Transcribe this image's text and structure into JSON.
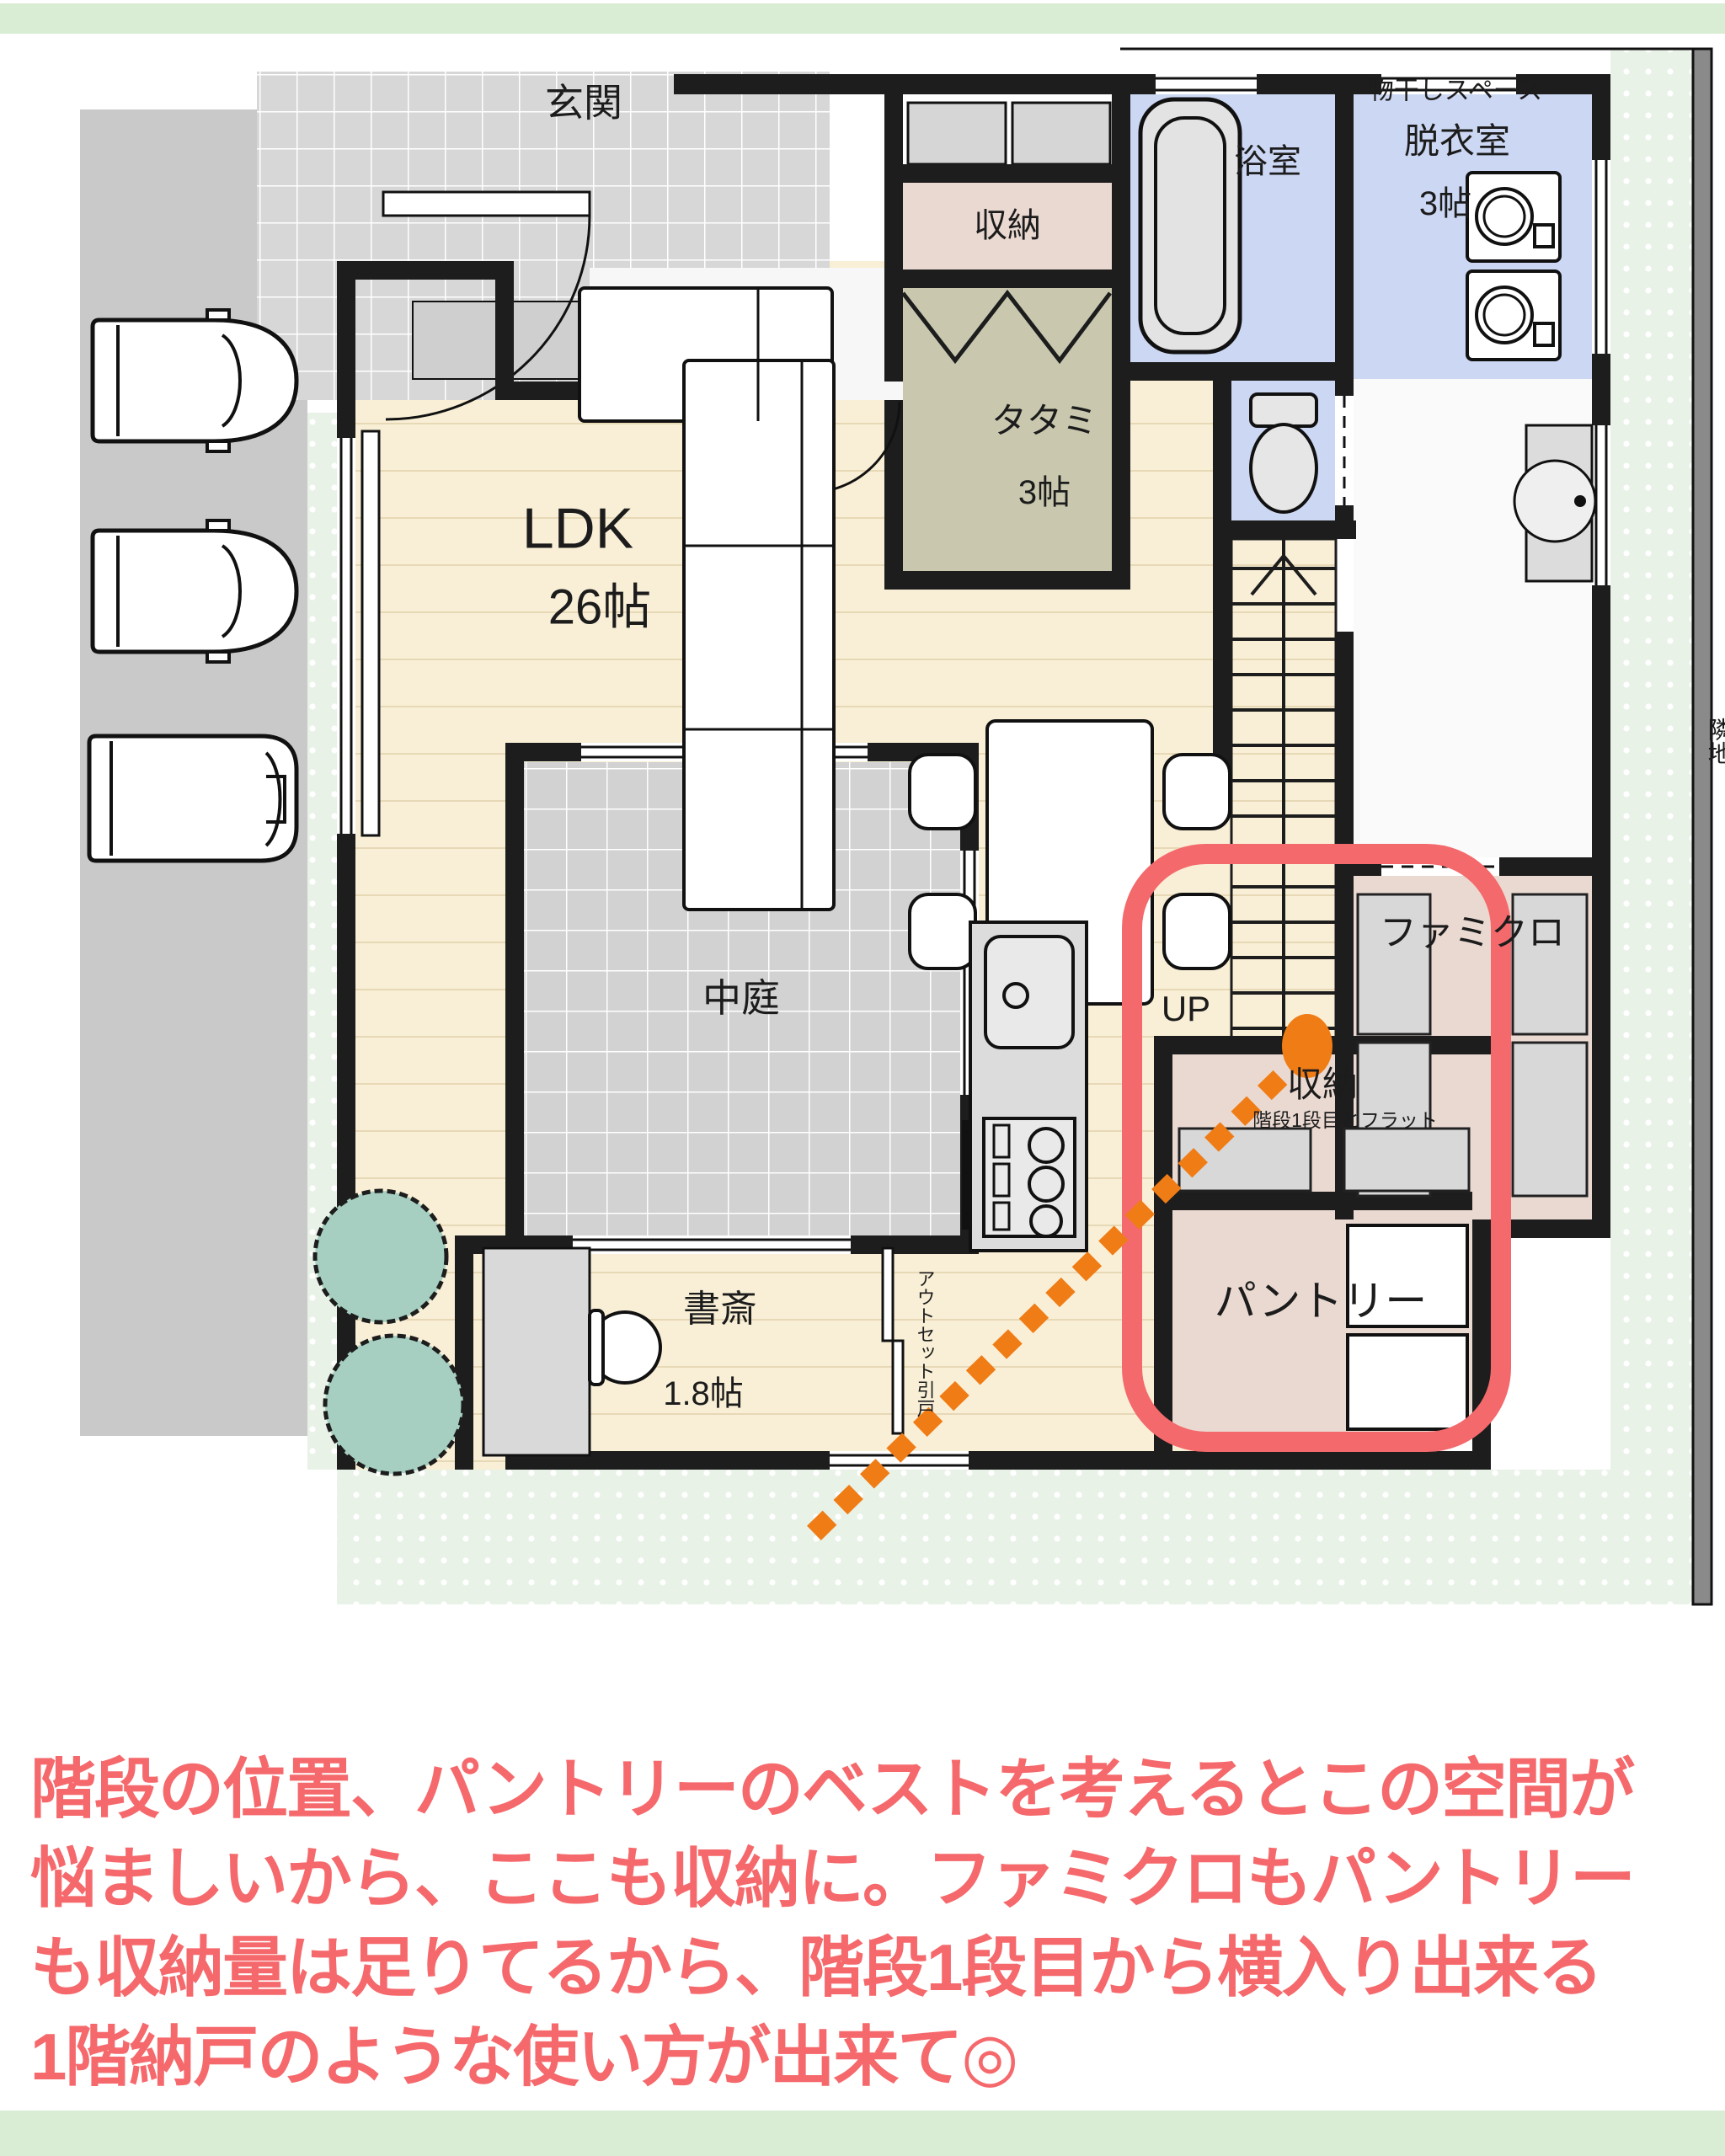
{
  "plan": {
    "rooms": {
      "genkan": {
        "label": "玄関"
      },
      "storage_top": {
        "label": "収納"
      },
      "bathroom": {
        "label": "浴室"
      },
      "drying_space": {
        "label": "物干しスペース"
      },
      "dressing_room": {
        "label": "脱衣室",
        "size": "3帖"
      },
      "tatami": {
        "label": "タタミ",
        "size": "3帖"
      },
      "ldk": {
        "label": "LDK",
        "size": "26帖"
      },
      "courtyard": {
        "label": "中庭"
      },
      "family_closet": {
        "label": "ファミクロ"
      },
      "stairs": {
        "label": "UP"
      },
      "storage_stairs": {
        "label": "収納",
        "note": "階段1段目とフラット"
      },
      "pantry": {
        "label": "パントリー"
      },
      "study": {
        "label": "書斎",
        "size": "1.8帖"
      }
    },
    "annotations": {
      "outset_sliding_door": "アウトセット引戸",
      "neighbor_site": "隣地"
    },
    "colors": {
      "accent_green_bar": "#d9edd4",
      "floor_wood": "#f9efd6",
      "tile_gray": "#d7d7d7",
      "water_blue": "#ccd7f3",
      "storage_pink": "#ead9d1",
      "tatami_olive": "#c9c8af",
      "garden_dot_green": "#e8f2e7",
      "wall_black": "#1d1d1d"
    }
  },
  "highlight": {
    "box_color": "#f4696b",
    "connector_color": "#f07c16"
  },
  "caption": {
    "color": "#f5696c",
    "lines": [
      "階段の位置、パントリーのベストを考えるとこの空間が",
      "悩ましいから、ここも収納に。ファミクロもパントリー",
      "も収納量は足りてるから、階段1段目から横入り出来る",
      "1階納戸のような使い方が出来て◎"
    ]
  }
}
